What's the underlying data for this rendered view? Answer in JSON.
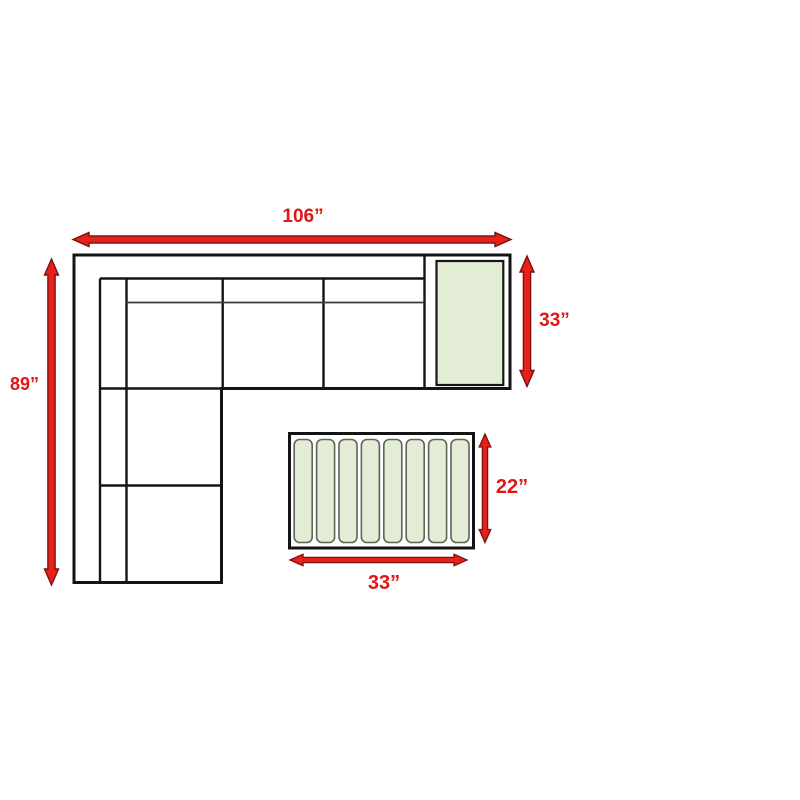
{
  "dimensions": {
    "sofa_width": {
      "value": "106”",
      "orientation": "horizontal"
    },
    "sofa_depth": {
      "value": "89”",
      "orientation": "vertical"
    },
    "end_table_depth": {
      "value": "33”",
      "orientation": "vertical"
    },
    "coffee_table_depth": {
      "value": "22”",
      "orientation": "vertical"
    },
    "coffee_table_width": {
      "value": "33”",
      "orientation": "horizontal"
    }
  },
  "coffee_table": {
    "slat_count": 8
  },
  "colors": {
    "arrow_red": "#e6201a",
    "arrow_edge": "#7c110d",
    "label_red": "#e01712",
    "table_green": "#e3edd6",
    "slat_border": "#5f6459",
    "outline_black": "#141414",
    "background": "#ffffff"
  }
}
